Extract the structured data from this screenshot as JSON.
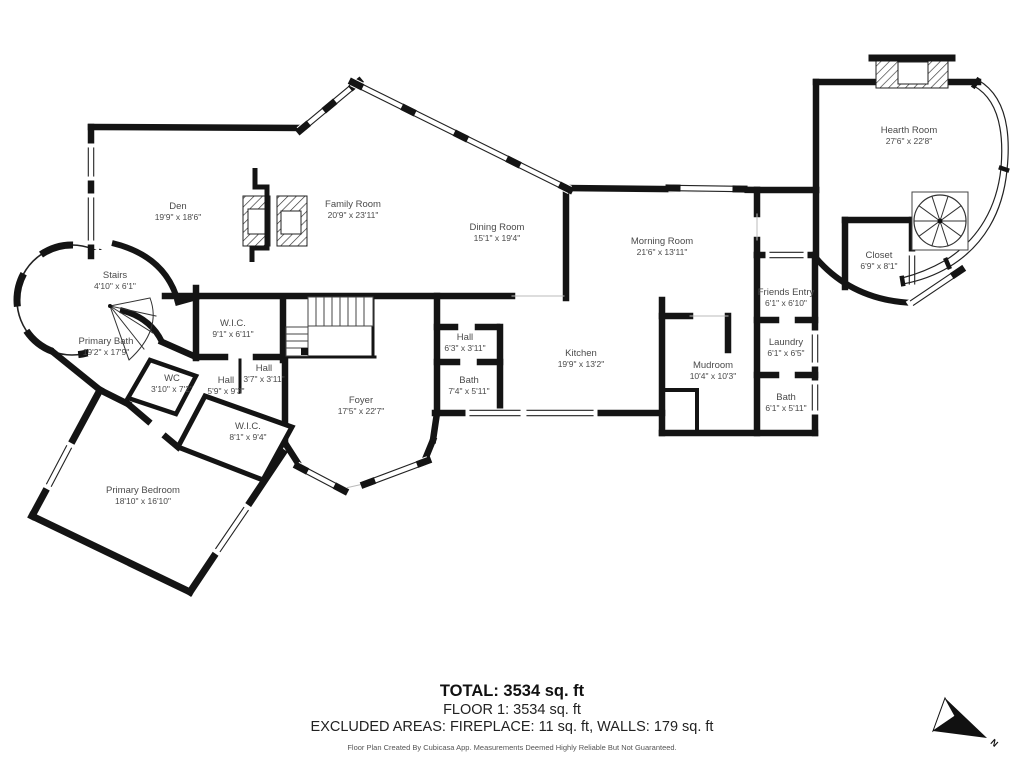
{
  "plan": {
    "rooms": [
      {
        "id": "den",
        "name": "Den",
        "dims": "19'9\" x 18'6\"",
        "x": 178,
        "y": 212
      },
      {
        "id": "family-room",
        "name": "Family Room",
        "dims": "20'9\" x 23'11\"",
        "x": 353,
        "y": 210
      },
      {
        "id": "dining-room",
        "name": "Dining Room",
        "dims": "15'1\" x 19'4\"",
        "x": 497,
        "y": 233
      },
      {
        "id": "morning-room",
        "name": "Morning Room",
        "dims": "21'6\" x 13'11\"",
        "x": 662,
        "y": 247
      },
      {
        "id": "hearth-room",
        "name": "Hearth Room",
        "dims": "27'6\" x 22'8\"",
        "x": 909,
        "y": 136
      },
      {
        "id": "closet",
        "name": "Closet",
        "dims": "6'9\" x 8'1\"",
        "x": 879,
        "y": 261
      },
      {
        "id": "friends-entry",
        "name": "Friends Entry",
        "dims": "6'1\" x 6'10\"",
        "x": 786,
        "y": 298
      },
      {
        "id": "laundry",
        "name": "Laundry",
        "dims": "6'1\" x 6'5\"",
        "x": 786,
        "y": 348
      },
      {
        "id": "bath-east",
        "name": "Bath",
        "dims": "6'1\" x 5'11\"",
        "x": 786,
        "y": 403
      },
      {
        "id": "mudroom",
        "name": "Mudroom",
        "dims": "10'4\" x 10'3\"",
        "x": 713,
        "y": 371
      },
      {
        "id": "kitchen",
        "name": "Kitchen",
        "dims": "19'9\" x 13'2\"",
        "x": 581,
        "y": 359
      },
      {
        "id": "hall-north",
        "name": "Hall",
        "dims": "6'3\" x 3'11\"",
        "x": 465,
        "y": 343
      },
      {
        "id": "bath-center",
        "name": "Bath",
        "dims": "7'4\" x 5'11\"",
        "x": 469,
        "y": 386
      },
      {
        "id": "foyer",
        "name": "Foyer",
        "dims": "17'5\" x 22'7\"",
        "x": 361,
        "y": 406
      },
      {
        "id": "hall-small",
        "name": "Hall",
        "dims": "3'7\" x 3'11\"",
        "x": 264,
        "y": 374
      },
      {
        "id": "hall-west",
        "name": "Hall",
        "dims": "5'9\" x 9'3\"",
        "x": 226,
        "y": 386
      },
      {
        "id": "wc",
        "name": "WC",
        "dims": "3'10\" x 7'2\"",
        "x": 172,
        "y": 384
      },
      {
        "id": "wic-north",
        "name": "W.I.C.",
        "dims": "9'1\" x 6'11\"",
        "x": 233,
        "y": 329
      },
      {
        "id": "wic-south",
        "name": "W.I.C.",
        "dims": "8'1\" x 9'4\"",
        "x": 248,
        "y": 432
      },
      {
        "id": "primary-bath",
        "name": "Primary Bath",
        "dims": "19'2\" x 17'9\"",
        "x": 106,
        "y": 347
      },
      {
        "id": "stairs",
        "name": "Stairs",
        "dims": "4'10\" x 6'1\"",
        "x": 115,
        "y": 281
      },
      {
        "id": "primary-bedroom",
        "name": "Primary Bedroom",
        "dims": "18'10\" x 16'10\"",
        "x": 143,
        "y": 496
      }
    ],
    "footer": {
      "total": "TOTAL: 3534 sq. ft",
      "floor": "FLOOR 1: 3534 sq. ft",
      "excluded": "EXCLUDED AREAS: FIREPLACE: 11 sq. ft, WALLS: 179 sq. ft",
      "disclaimer": "Floor Plan Created By Cubicasa App. Measurements Deemed Highly Reliable But Not Guaranteed."
    },
    "compass": {
      "label": "N"
    },
    "colors": {
      "wall": "#141414",
      "label_text": "#4a4a4a",
      "footer_text": "#1c1c1c"
    }
  }
}
